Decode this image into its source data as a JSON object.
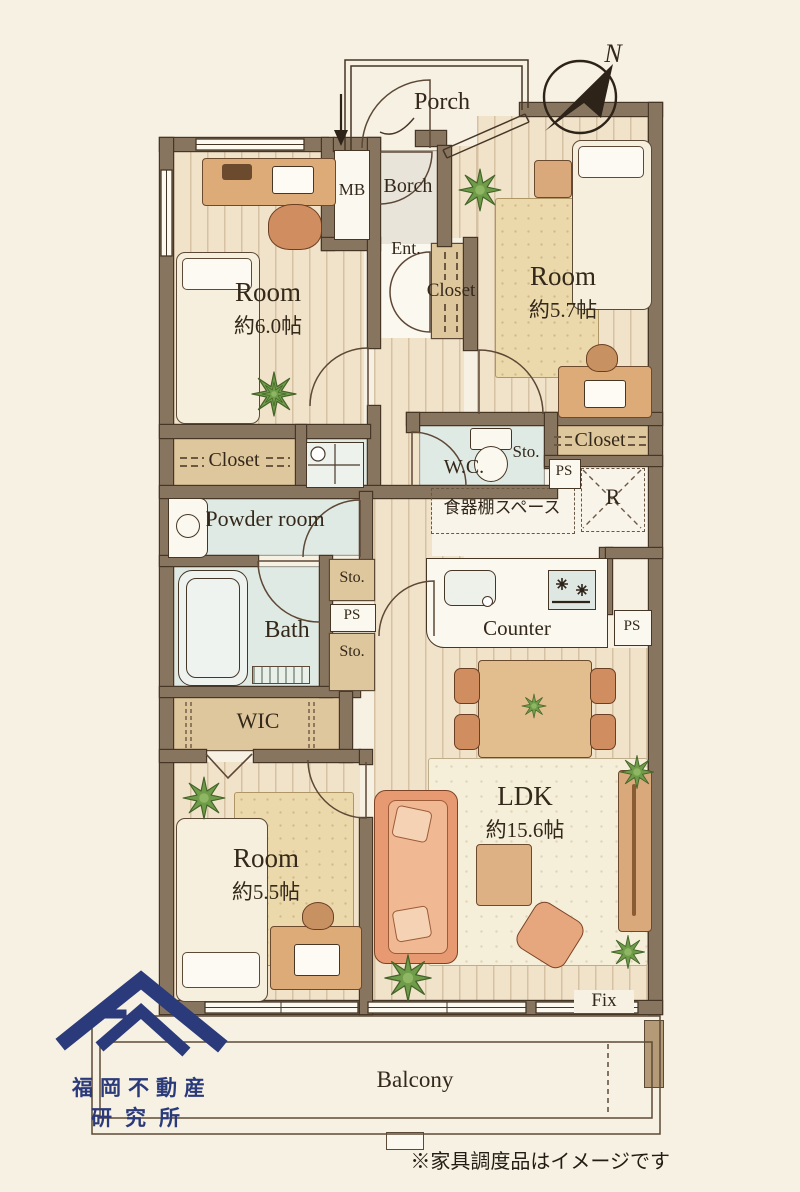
{
  "colors": {
    "paper": "#f6f1e3",
    "wall": "#87755f",
    "wall_edge": "#463626",
    "brand_navy": "#2b3a7a",
    "ink": "#33281a"
  },
  "compass": {
    "north_label": "N"
  },
  "entry": {
    "porch": "Porch",
    "borch": "Borch",
    "mb": "MB",
    "ent": "Ent.",
    "closet": "Closet"
  },
  "rooms": {
    "room_nw": {
      "label": "Room",
      "size": "約6.0帖"
    },
    "room_ne": {
      "label": "Room",
      "size": "約5.7帖"
    },
    "room_sw": {
      "label": "Room",
      "size": "約5.5帖"
    },
    "ldk": {
      "label": "LDK",
      "size": "約15.6帖"
    },
    "wic": {
      "label": "WIC"
    },
    "bath": {
      "label": "Bath"
    },
    "powder": {
      "label": "Powder room"
    },
    "wc": {
      "label": "W.C."
    },
    "balcony": {
      "label": "Balcony"
    }
  },
  "storage": {
    "closet_nw": "Closet",
    "closet_ne": "Closet",
    "sto_wc": "Sto.",
    "sto_upper": "Sto.",
    "sto_lower": "Sto.",
    "ps_wc": "PS",
    "ps_hall": "PS",
    "ps_kitchen": "PS"
  },
  "kitchen": {
    "counter": "Counter",
    "cupboard_space": "食器棚スペース",
    "fridge": "R"
  },
  "openings": {
    "fix": "Fix"
  },
  "logo": {
    "line1": "福岡不動産",
    "line2": "研究所"
  },
  "footnote": "※家具調度品はイメージです"
}
